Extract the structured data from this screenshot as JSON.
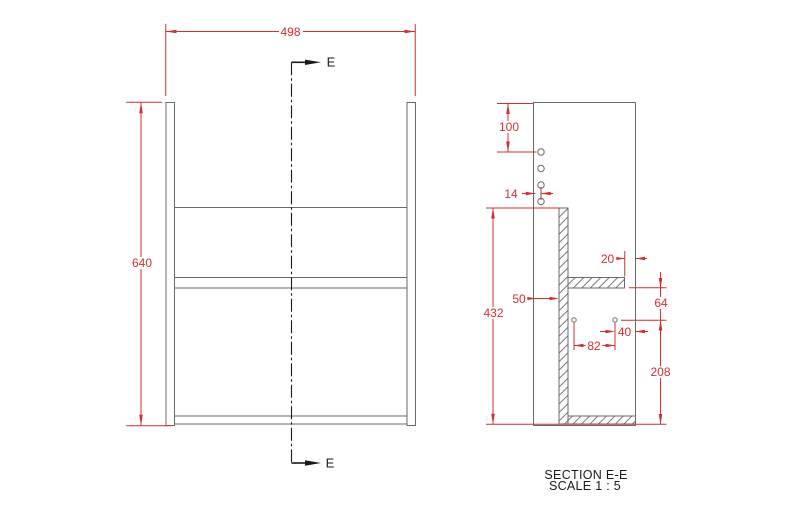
{
  "drawing": {
    "type": "engineering-drawing",
    "units": "mm",
    "colors": {
      "dimension": "#d22f2f",
      "geometry": "#6a6a6a",
      "annotation": "#1a1a1a",
      "background": "#ffffff"
    },
    "front_view": {
      "width": "498",
      "height": "640",
      "section_marker": "E"
    },
    "section_view": {
      "title": "SECTION E-E",
      "scale": "SCALE 1 : 5",
      "dim_hole_from_top": "100",
      "dim_hole_from_back": "14",
      "dim_false_back_setback": "50",
      "dim_inner_height": "432",
      "dim_shelf_setback": "20",
      "dim_hole_below_shelf": "64",
      "dim_hole_spacing": "82",
      "dim_hole_from_front": "40",
      "dim_hole_above_bottom": "208"
    }
  }
}
